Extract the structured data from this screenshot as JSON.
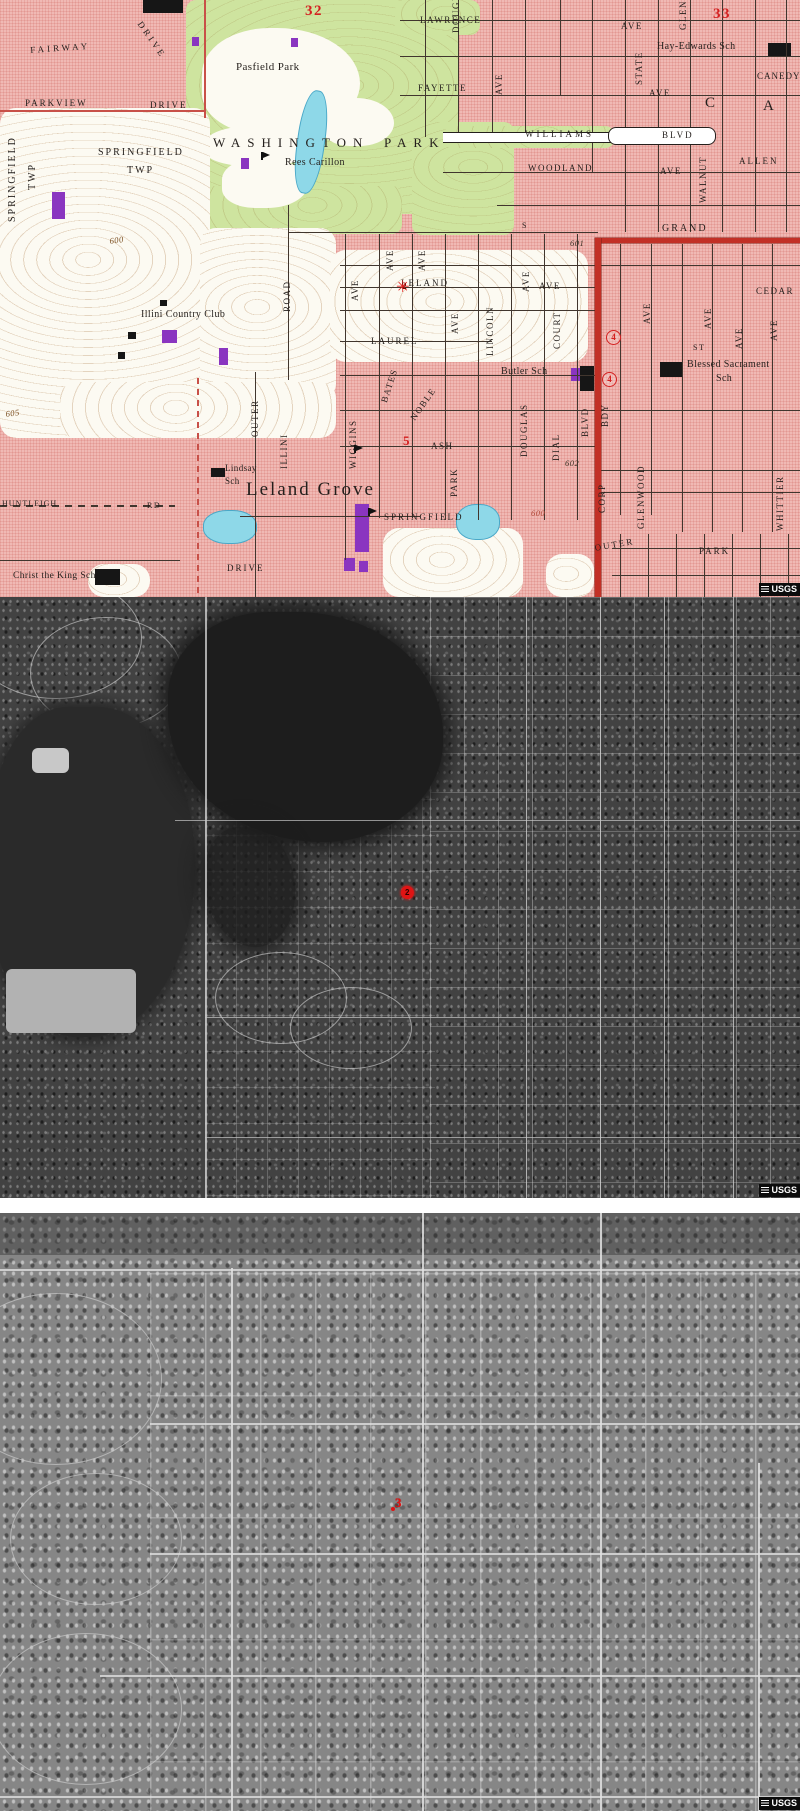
{
  "topo": {
    "labels": [
      {
        "t": "LAWRENCE",
        "x": 420,
        "y": 16
      },
      {
        "t": "AVE",
        "x": 621,
        "y": 22
      },
      {
        "t": "DRIVE",
        "x": 143,
        "y": 20,
        "r": 55,
        "ls": 3
      },
      {
        "t": "FAIRWAY",
        "x": 30,
        "y": 46,
        "ls": 3,
        "r": -4
      },
      {
        "t": "PARKVIEW",
        "x": 25,
        "y": 99,
        "ls": 2
      },
      {
        "t": "DRIVE",
        "x": 150,
        "y": 101,
        "ls": 2
      },
      {
        "t": "SPRINGFIELD",
        "x": 98,
        "y": 148,
        "s": 10,
        "ls": 2
      },
      {
        "t": "TWP",
        "x": 127,
        "y": 166,
        "s": 10,
        "ls": 2
      },
      {
        "t": "FAYETTE",
        "x": 418,
        "y": 84
      },
      {
        "t": "AVE",
        "x": 649,
        "y": 89
      },
      {
        "t": "WILLIAMS",
        "x": 525,
        "y": 130,
        "ls": 3
      },
      {
        "t": "BLVD",
        "x": 662,
        "y": 131,
        "ls": 2
      },
      {
        "t": "WOODLAND",
        "x": 528,
        "y": 164
      },
      {
        "t": "AVE",
        "x": 660,
        "y": 167
      },
      {
        "t": "ALLEN",
        "x": 739,
        "y": 157,
        "ls": 2
      },
      {
        "t": "CANEDY",
        "x": 757,
        "y": 72,
        "ls": 1
      },
      {
        "t": "GRAND",
        "x": 662,
        "y": 224,
        "s": 10,
        "ls": 2
      },
      {
        "t": "S",
        "x": 522,
        "y": 222,
        "s": 8
      },
      {
        "t": "LELAND",
        "x": 401,
        "y": 279,
        "ls": 2
      },
      {
        "t": "AVE",
        "x": 539,
        "y": 282
      },
      {
        "t": "LAUREL",
        "x": 371,
        "y": 337,
        "ls": 2
      },
      {
        "t": "ASH",
        "x": 431,
        "y": 442
      },
      {
        "t": "CEDAR",
        "x": 756,
        "y": 287
      },
      {
        "t": "ST",
        "x": 693,
        "y": 344,
        "s": 8
      },
      {
        "t": "HUNTLEIGH",
        "x": 2,
        "y": 500,
        "s": 8,
        "ls": 1
      },
      {
        "t": "RD",
        "x": 147,
        "y": 502,
        "s": 8
      },
      {
        "t": "DRIVE",
        "x": 227,
        "y": 564,
        "ls": 2
      },
      {
        "t": "OUTER",
        "x": 594,
        "y": 544,
        "r": -10,
        "ls": 2
      },
      {
        "t": "PARK",
        "x": 699,
        "y": 547,
        "ls": 2
      },
      {
        "t": "SPRINGFIELD",
        "x": 8,
        "y": 222,
        "r": -90,
        "s": 10,
        "ls": 2
      },
      {
        "t": "TWP",
        "x": 28,
        "y": 190,
        "r": -90,
        "s": 10,
        "ls": 2
      },
      {
        "t": "AVE",
        "x": 495,
        "y": 95,
        "r": -90
      },
      {
        "t": "STATE",
        "x": 635,
        "y": 85,
        "r": -90
      },
      {
        "t": "GLEN",
        "x": 679,
        "y": 30,
        "r": -90
      },
      {
        "t": "DOUGLAS",
        "x": 452,
        "y": 33,
        "r": -90
      },
      {
        "t": "WALNUT",
        "x": 699,
        "y": 203,
        "r": -90
      },
      {
        "t": "ROAD",
        "x": 283,
        "y": 312,
        "r": -90
      },
      {
        "t": "AVE",
        "x": 386,
        "y": 271,
        "r": -90
      },
      {
        "t": "AVE",
        "x": 418,
        "y": 271,
        "r": -90
      },
      {
        "t": "AVE",
        "x": 351,
        "y": 301,
        "r": -90
      },
      {
        "t": "AVE",
        "x": 522,
        "y": 292,
        "r": -90
      },
      {
        "t": "LINCOLN",
        "x": 486,
        "y": 356,
        "r": -90
      },
      {
        "t": "AVE",
        "x": 451,
        "y": 334,
        "r": -90
      },
      {
        "t": "COURT",
        "x": 553,
        "y": 349,
        "r": -90
      },
      {
        "t": "AVE",
        "x": 643,
        "y": 324,
        "r": -90
      },
      {
        "t": "AVE",
        "x": 704,
        "y": 329,
        "r": -90
      },
      {
        "t": "AVE",
        "x": 735,
        "y": 349,
        "r": -90
      },
      {
        "t": "AVE",
        "x": 770,
        "y": 341,
        "r": -90
      },
      {
        "t": "BATES",
        "x": 380,
        "y": 401,
        "r": -72
      },
      {
        "t": "NOBLE",
        "x": 409,
        "y": 417,
        "r": -55
      },
      {
        "t": "WIGGINS",
        "x": 349,
        "y": 469,
        "r": -90
      },
      {
        "t": "ILLINI",
        "x": 280,
        "y": 469,
        "r": -90
      },
      {
        "t": "OUTER",
        "x": 251,
        "y": 437,
        "r": -90
      },
      {
        "t": "DOUGLAS",
        "x": 520,
        "y": 457,
        "r": -90
      },
      {
        "t": "DIAL",
        "x": 552,
        "y": 461,
        "r": -90
      },
      {
        "t": "BLVD",
        "x": 581,
        "y": 437,
        "r": -90
      },
      {
        "t": "BDY",
        "x": 601,
        "y": 427,
        "r": -90
      },
      {
        "t": "CORP",
        "x": 598,
        "y": 513,
        "r": -90
      },
      {
        "t": "GLENWOOD",
        "x": 637,
        "y": 529,
        "r": -90
      },
      {
        "t": "WHITTIER",
        "x": 776,
        "y": 531,
        "r": -90
      },
      {
        "t": "PARK",
        "x": 450,
        "y": 497,
        "r": -90
      },
      {
        "t": "Pasfield Park",
        "x": 236,
        "y": 62,
        "s": 11,
        "cls": "pl"
      },
      {
        "t": "WASHINGTON",
        "x": 213,
        "y": 136,
        "s": 13,
        "ls": 7,
        "cls": "pl"
      },
      {
        "t": "PARK",
        "x": 384,
        "y": 136,
        "s": 13,
        "ls": 7,
        "cls": "pl"
      },
      {
        "t": "Rees Carillon",
        "x": 285,
        "y": 158,
        "s": 10,
        "cls": "pl"
      },
      {
        "t": "Hay-Edwards Sch",
        "x": 657,
        "y": 42,
        "s": 10,
        "cls": "pl"
      },
      {
        "t": "Illini Country Club",
        "x": 141,
        "y": 310,
        "s": 10,
        "cls": "pl"
      },
      {
        "t": "Butler Sch",
        "x": 501,
        "y": 367,
        "s": 10,
        "cls": "pl"
      },
      {
        "t": "Blessed Sacrament",
        "x": 687,
        "y": 360,
        "s": 10,
        "cls": "pl"
      },
      {
        "t": "Sch",
        "x": 716,
        "y": 374,
        "s": 10,
        "cls": "pl"
      },
      {
        "t": "Lindsay",
        "x": 225,
        "y": 464,
        "s": 9,
        "cls": "pl"
      },
      {
        "t": "Sch",
        "x": 225,
        "y": 477,
        "s": 9,
        "cls": "pl"
      },
      {
        "t": "Leland Grove",
        "x": 246,
        "y": 480,
        "s": 19,
        "ls": 2,
        "cls": "pl"
      },
      {
        "t": "SPRINGFIELD",
        "x": 384,
        "y": 513,
        "s": 9,
        "ls": 2,
        "cls": "pl"
      },
      {
        "t": "Christ the King Sch",
        "x": 13,
        "y": 572,
        "s": 9.5,
        "cls": "pl"
      },
      {
        "t": "C",
        "x": 705,
        "y": 96,
        "s": 15,
        "cls": "pl"
      },
      {
        "t": "A",
        "x": 763,
        "y": 99,
        "s": 15,
        "cls": "pl"
      },
      {
        "t": "600",
        "x": 109,
        "y": 237,
        "cls": "el",
        "r": -8
      },
      {
        "t": "605",
        "x": 5,
        "y": 410,
        "cls": "el",
        "r": -8
      },
      {
        "t": "600",
        "x": 531,
        "y": 509,
        "cls": "el",
        "c": "#b04838"
      },
      {
        "t": "601",
        "x": 570,
        "y": 239,
        "cls": "el",
        "c": "#3f362a"
      },
      {
        "t": "602",
        "x": 565,
        "y": 459,
        "cls": "el",
        "c": "#3f362a"
      },
      {
        "t": "32",
        "x": 305,
        "y": 4,
        "s": 15,
        "cls": "rd"
      },
      {
        "t": "33",
        "x": 713,
        "y": 7,
        "s": 15,
        "cls": "rd"
      },
      {
        "t": "5",
        "x": 403,
        "y": 434,
        "s": 13,
        "cls": "rd"
      }
    ],
    "markers": {
      "site2": "2",
      "route4a": "4",
      "route4b": "4"
    },
    "usgs": "USGS"
  },
  "aerial_mid": {
    "marker": "2",
    "usgs": "USGS"
  },
  "aerial_low": {
    "marker": "3",
    "usgs": "USGS"
  }
}
